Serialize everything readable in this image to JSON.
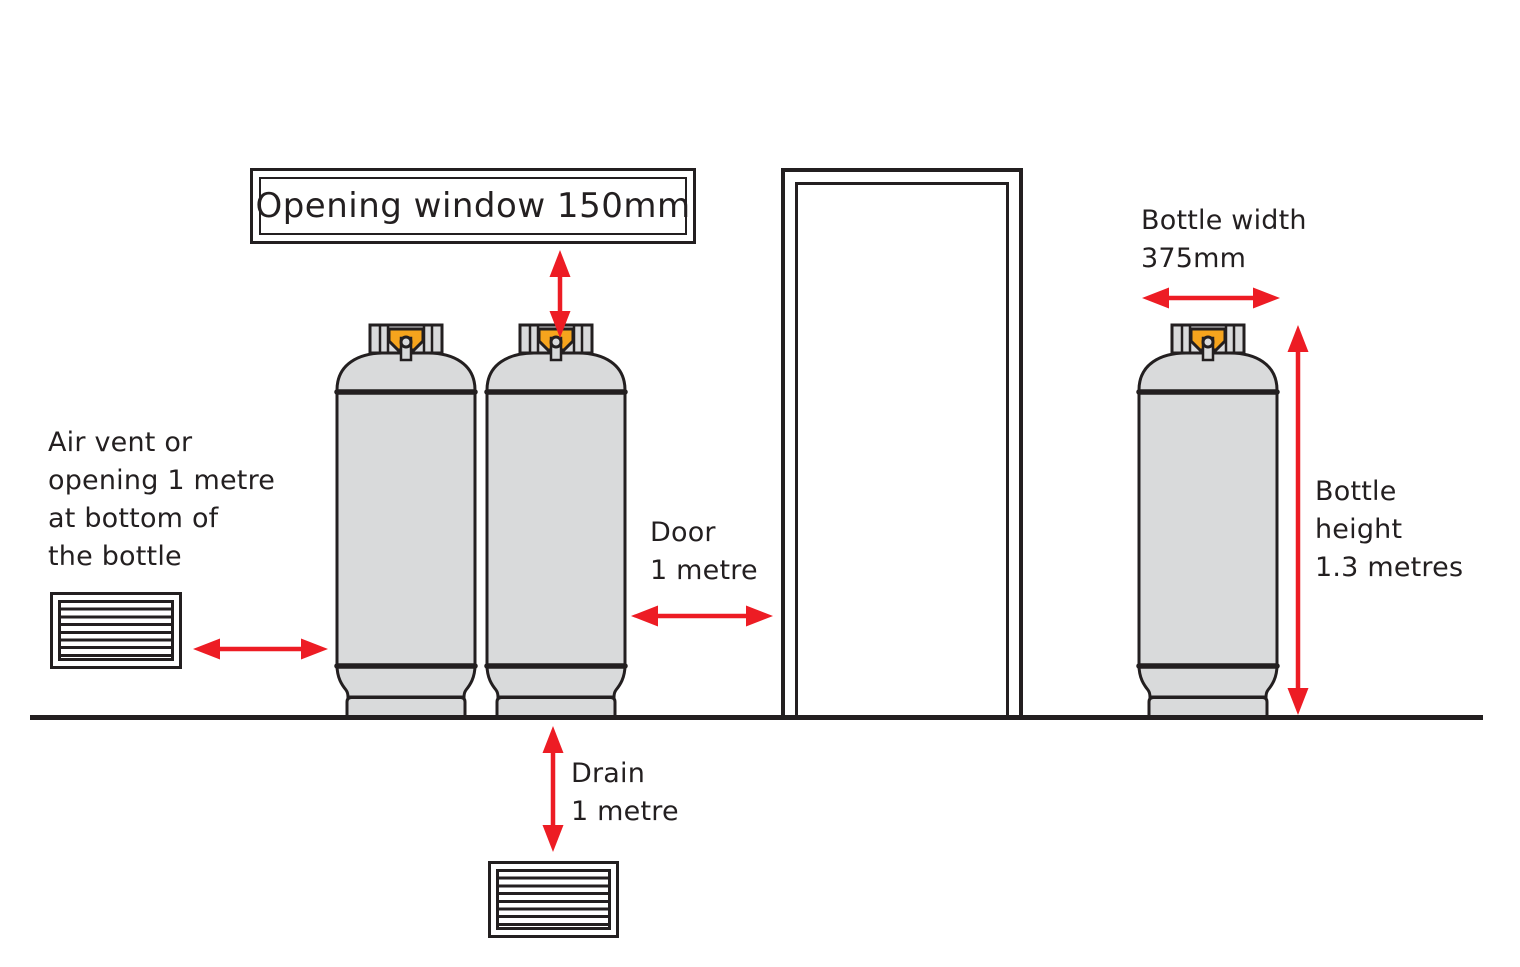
{
  "colors": {
    "ink": "#231f20",
    "bottle_grey": "#d9dadb",
    "valve_orange": "#f6a41d",
    "arrow_red": "#ed1c24",
    "bg": "#ffffff"
  },
  "labels": {
    "opening_window": "Opening window 150mm",
    "air_vent": "Air vent or\nopening 1 metre\nat bottom of\nthe bottle",
    "door": "Door\n1 metre",
    "drain": "Drain\n1 metre",
    "bottle_width": "Bottle width\n375mm",
    "bottle_height": "Bottle\nheight\n1.3 metres"
  }
}
